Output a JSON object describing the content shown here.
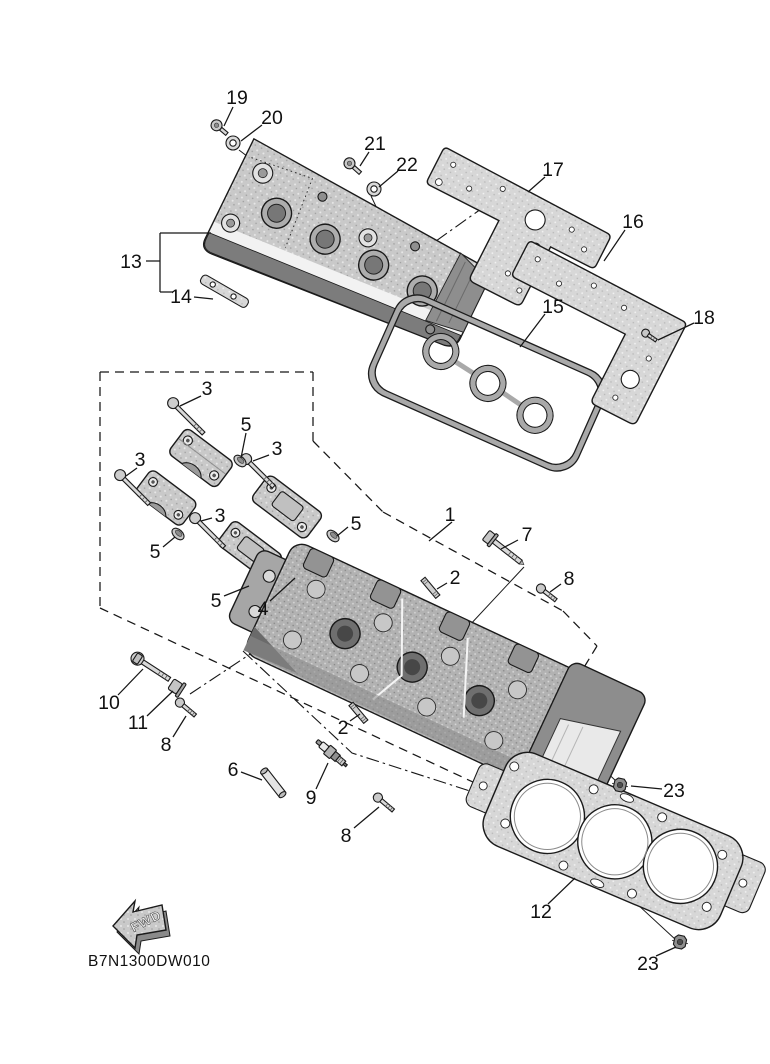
{
  "document": {
    "drawing_code": "B7N1300DW010",
    "fwd_label": "FWD"
  },
  "callouts": [
    {
      "id": "19",
      "text": "19",
      "label": {
        "x": 237,
        "y": 97
      },
      "leader": [
        [
          233,
          107
        ],
        [
          224,
          126
        ]
      ]
    },
    {
      "id": "20",
      "text": "20",
      "label": {
        "x": 272,
        "y": 117
      },
      "leader": [
        [
          262,
          125
        ],
        [
          241,
          141
        ]
      ]
    },
    {
      "id": "21",
      "text": "21",
      "label": {
        "x": 375,
        "y": 143
      },
      "leader": [
        [
          369,
          152
        ],
        [
          360,
          166
        ]
      ]
    },
    {
      "id": "22",
      "text": "22",
      "label": {
        "x": 407,
        "y": 164
      },
      "leader": [
        [
          398,
          171
        ],
        [
          379,
          187
        ]
      ]
    },
    {
      "id": "17",
      "text": "17",
      "label": {
        "x": 553,
        "y": 169
      },
      "leader": [
        [
          545,
          177
        ],
        [
          528,
          192
        ]
      ]
    },
    {
      "id": "16",
      "text": "16",
      "label": {
        "x": 633,
        "y": 221
      },
      "leader": [
        [
          625,
          230
        ],
        [
          604,
          261
        ]
      ]
    },
    {
      "id": "18",
      "text": "18",
      "label": {
        "x": 704,
        "y": 317
      },
      "leader": [
        [
          694,
          323
        ],
        [
          658,
          340
        ]
      ]
    },
    {
      "id": "15",
      "text": "15",
      "label": {
        "x": 553,
        "y": 306
      },
      "leader": [
        [
          545,
          314
        ],
        [
          520,
          347
        ]
      ]
    },
    {
      "id": "13",
      "text": "13",
      "label": {
        "x": 131,
        "y": 261
      }
    },
    {
      "id": "14",
      "text": "14",
      "label": {
        "x": 181,
        "y": 296
      },
      "leader": [
        [
          194,
          297
        ],
        [
          213,
          299
        ]
      ]
    },
    {
      "id": "3a",
      "text": "3",
      "label": {
        "x": 207,
        "y": 388
      },
      "leader": [
        [
          201,
          396
        ],
        [
          180,
          406
        ]
      ]
    },
    {
      "id": "3b",
      "text": "3",
      "label": {
        "x": 140,
        "y": 459
      },
      "leader": [
        [
          137,
          468
        ],
        [
          126,
          476
        ]
      ]
    },
    {
      "id": "3c",
      "text": "3",
      "label": {
        "x": 277,
        "y": 448
      },
      "leader": [
        [
          269,
          455
        ],
        [
          253,
          461
        ]
      ]
    },
    {
      "id": "3d",
      "text": "3",
      "label": {
        "x": 220,
        "y": 515
      },
      "leader": [
        [
          212,
          518
        ],
        [
          201,
          521
        ]
      ]
    },
    {
      "id": "5a",
      "text": "5",
      "label": {
        "x": 246,
        "y": 424
      },
      "leader": [
        [
          246,
          433
        ],
        [
          241,
          458
        ]
      ]
    },
    {
      "id": "5b",
      "text": "5",
      "label": {
        "x": 155,
        "y": 551
      },
      "leader": [
        [
          163,
          547
        ],
        [
          175,
          537
        ]
      ]
    },
    {
      "id": "5c",
      "text": "5",
      "label": {
        "x": 356,
        "y": 523
      },
      "leader": [
        [
          348,
          527
        ],
        [
          337,
          536
        ]
      ]
    },
    {
      "id": "5d",
      "text": "5",
      "label": {
        "x": 216,
        "y": 600
      },
      "leader": [
        [
          224,
          596
        ],
        [
          249,
          586
        ]
      ]
    },
    {
      "id": "4",
      "text": "4",
      "label": {
        "x": 263,
        "y": 608
      },
      "leader": [
        [
          270,
          601
        ],
        [
          295,
          578
        ]
      ]
    },
    {
      "id": "1",
      "text": "1",
      "label": {
        "x": 450,
        "y": 514
      },
      "leader": [
        [
          452,
          522
        ],
        [
          429,
          541
        ]
      ]
    },
    {
      "id": "7",
      "text": "7",
      "label": {
        "x": 527,
        "y": 534
      },
      "leader": [
        [
          518,
          540
        ],
        [
          501,
          549
        ]
      ]
    },
    {
      "id": "2a",
      "text": "2",
      "label": {
        "x": 455,
        "y": 577
      },
      "leader": [
        [
          447,
          583
        ],
        [
          437,
          589
        ]
      ]
    },
    {
      "id": "2b",
      "text": "2",
      "label": {
        "x": 343,
        "y": 727
      },
      "leader": [
        [
          350,
          721
        ],
        [
          360,
          714
        ]
      ]
    },
    {
      "id": "8a",
      "text": "8",
      "label": {
        "x": 569,
        "y": 578
      },
      "leader": [
        [
          561,
          584
        ],
        [
          550,
          592
        ]
      ]
    },
    {
      "id": "8b",
      "text": "8",
      "label": {
        "x": 166,
        "y": 744
      },
      "leader": [
        [
          173,
          737
        ],
        [
          186,
          716
        ]
      ]
    },
    {
      "id": "8c",
      "text": "8",
      "label": {
        "x": 346,
        "y": 835
      },
      "leader": [
        [
          354,
          828
        ],
        [
          379,
          807
        ]
      ]
    },
    {
      "id": "10",
      "text": "10",
      "label": {
        "x": 109,
        "y": 702
      },
      "leader": [
        [
          118,
          695
        ],
        [
          143,
          669
        ]
      ]
    },
    {
      "id": "11",
      "text": "11",
      "label": {
        "x": 138,
        "y": 722
      },
      "leader": [
        [
          147,
          716
        ],
        [
          173,
          691
        ]
      ]
    },
    {
      "id": "6",
      "text": "6",
      "label": {
        "x": 233,
        "y": 769
      },
      "leader": [
        [
          241,
          772
        ],
        [
          262,
          780
        ]
      ]
    },
    {
      "id": "9",
      "text": "9",
      "label": {
        "x": 311,
        "y": 797
      },
      "leader": [
        [
          316,
          789
        ],
        [
          328,
          763
        ]
      ]
    },
    {
      "id": "23a",
      "text": "23",
      "label": {
        "x": 674,
        "y": 790
      },
      "leader": [
        [
          662,
          789
        ],
        [
          631,
          786
        ]
      ]
    },
    {
      "id": "12",
      "text": "12",
      "label": {
        "x": 541,
        "y": 911
      },
      "leader": [
        [
          548,
          904
        ],
        [
          575,
          878
        ]
      ]
    },
    {
      "id": "23b",
      "text": "23",
      "label": {
        "x": 648,
        "y": 963
      },
      "leader": [
        [
          656,
          956
        ],
        [
          676,
          947
        ]
      ]
    }
  ]
}
